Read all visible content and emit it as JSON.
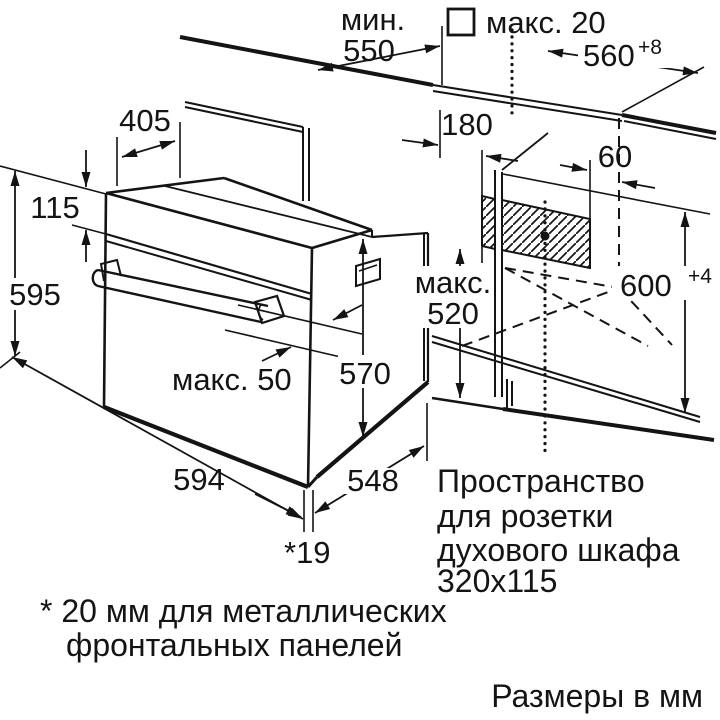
{
  "colors": {
    "line": "#141414",
    "background": "#ffffff"
  },
  "dims": {
    "min_depth_label": "мин.",
    "min_depth_value": "550",
    "max_protrusion_label": "макс. 20",
    "niche_width": "560",
    "niche_width_tol": "+8",
    "top_depth": "405",
    "panel_height": "115",
    "oven_height": "595",
    "socket_offset_left": "180",
    "socket_offset_right": "60",
    "niche_height": "600",
    "niche_height_tol": "+4",
    "max_inner_label": "макс.",
    "max_inner_value": "520",
    "body_depth": "570",
    "handle_max_label": "макс. 50",
    "oven_width": "594",
    "body_width": "548",
    "front_gap": "*19"
  },
  "socket_note": {
    "line1": "Пространство",
    "line2": "для розетки",
    "line3": "духового шкафа",
    "line4": "320x115"
  },
  "footnote": {
    "line1": "* 20 мм для металлических",
    "line2": "фронтальных панелей"
  },
  "units_note": "Размеры в мм",
  "icons": {
    "square_symbol": "metal-front-marker"
  }
}
